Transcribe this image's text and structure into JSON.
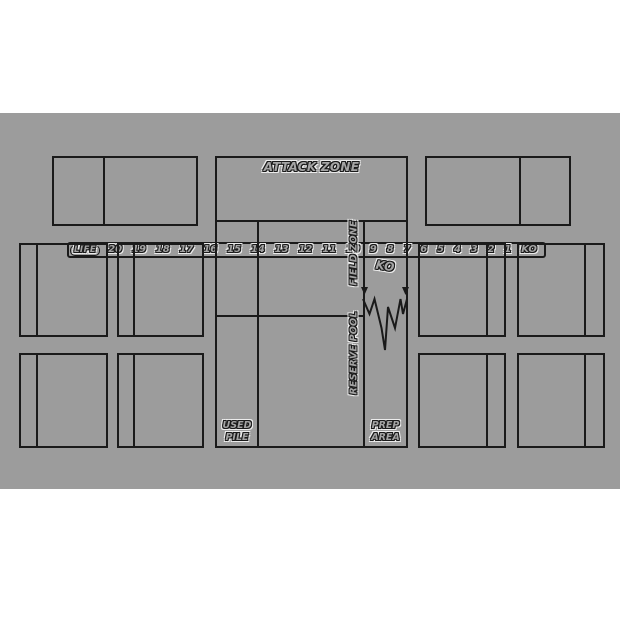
{
  "colors": {
    "page_bg": "#ffffff",
    "mat_bg": "#9c9c9c",
    "line": "#1a1a1a",
    "text_fill": "#a4a4a4",
    "halo": "#ececec"
  },
  "life_bar": {
    "label": "LIFE",
    "values": [
      "20",
      "19",
      "18",
      "17",
      "16",
      "15",
      "14",
      "13",
      "12",
      "11",
      "10",
      "9",
      "8",
      "7",
      "6",
      "5",
      "4",
      "3",
      "2",
      "1",
      "KO"
    ]
  },
  "zones": {
    "attack": "ATTACK ZONE",
    "field": "FIELD ZONE",
    "reserve": "RESERVE POOL",
    "ko": "KO",
    "used_pile": [
      "USED",
      "PILE"
    ],
    "prep_area": [
      "PREP",
      "AREA"
    ]
  }
}
